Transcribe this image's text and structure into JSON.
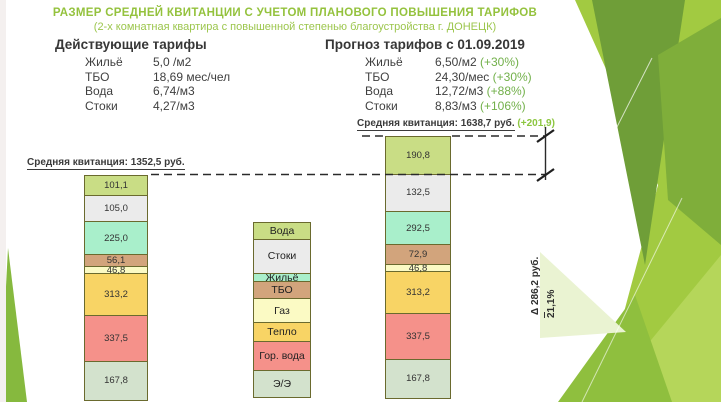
{
  "slide": {
    "title": "РАЗМЕР СРЕДНЕЙ КВИТАНЦИИ С УЧЕТОМ ПЛАНОВОГО ПОВЫШЕНИЯ ТАРИФОВ",
    "subtitle": "(2-х комнатная квартира с повышенной степенью благоустройства г. ДОНЕЦК)"
  },
  "current_tariffs": {
    "heading": "Действующие тарифы",
    "rows": [
      {
        "label": "Жильё",
        "value": "5,0 /м2",
        "change": ""
      },
      {
        "label": "ТБО",
        "value": "18,69 мес/чел",
        "change": ""
      },
      {
        "label": "Вода",
        "value": "6,74/м3",
        "change": ""
      },
      {
        "label": "Стоки",
        "value": "4,27/м3",
        "change": ""
      }
    ]
  },
  "forecast_tariffs": {
    "heading": "Прогноз тарифов с 01.09.2019",
    "rows": [
      {
        "label": "Жильё",
        "value": "6,50/м2",
        "change": "(+30%)"
      },
      {
        "label": "ТБО",
        "value": "24,30/мес",
        "change": "(+30%)"
      },
      {
        "label": "Вода",
        "value": "12,72/м3",
        "change": "(+88%)"
      },
      {
        "label": "Стоки",
        "value": "8,83/м3",
        "change": "(+106%)"
      }
    ]
  },
  "chart_data": {
    "type": "bar",
    "stacked": true,
    "unit": "руб.",
    "categories": [
      "Вода",
      "Стоки",
      "Жильё",
      "ТБО",
      "Газ",
      "Тепло",
      "Гор. вода",
      "Э/Э"
    ],
    "palette": {
      "Вода": "#c9dd85",
      "Стоки": "#ebebeb",
      "Жильё": "#a9efcb",
      "ТБО": "#d2a47c",
      "Газ": "#fbfac4",
      "Тепло": "#f8d465",
      "Гор. вода": "#f5918a",
      "Э/Э": "#d3e2cd"
    },
    "series": [
      {
        "name": "Действующие тарифы",
        "label": "Средняя квитанция: 1352,5 руб.",
        "total": 1352.5,
        "values": [
          101.1,
          105.0,
          225.0,
          56.1,
          46.8,
          313.2,
          337.5,
          167.8
        ],
        "display": [
          "101,1",
          "105,0",
          "225,0",
          "56,1",
          "46,8",
          "313,2",
          "337,5",
          "167,8"
        ]
      },
      {
        "name": "Прогноз тарифов с 01.09.2019",
        "label": "Средняя квитанция: 1638,7 руб.",
        "delta_label": "(+201,9)",
        "total": 1638.7,
        "values": [
          190.8,
          132.5,
          292.5,
          72.9,
          46.8,
          313.2,
          337.5,
          167.8
        ],
        "display": [
          "190,8",
          "132,5",
          "292,5",
          "72,9",
          "46,8",
          "313,2",
          "337,5",
          "167,8"
        ]
      }
    ],
    "annotations": {
      "delta": "Δ 286,2 руб.",
      "percent": "21,1%"
    },
    "layout": {
      "legend_position": "center-between-bars",
      "left_bar_heights": [
        21,
        27,
        35,
        13,
        8,
        43,
        47,
        40
      ],
      "right_bar_heights": [
        39,
        38,
        35,
        21,
        8,
        43,
        47,
        40
      ],
      "legend_heights": [
        18,
        35,
        10,
        18,
        25,
        20,
        30,
        28
      ]
    }
  },
  "colors": {
    "title_green": "#94c23d",
    "accent_green": "#72b04a",
    "segment_border": "#6a6a2e",
    "dimension_line": "#2a2a2a"
  }
}
